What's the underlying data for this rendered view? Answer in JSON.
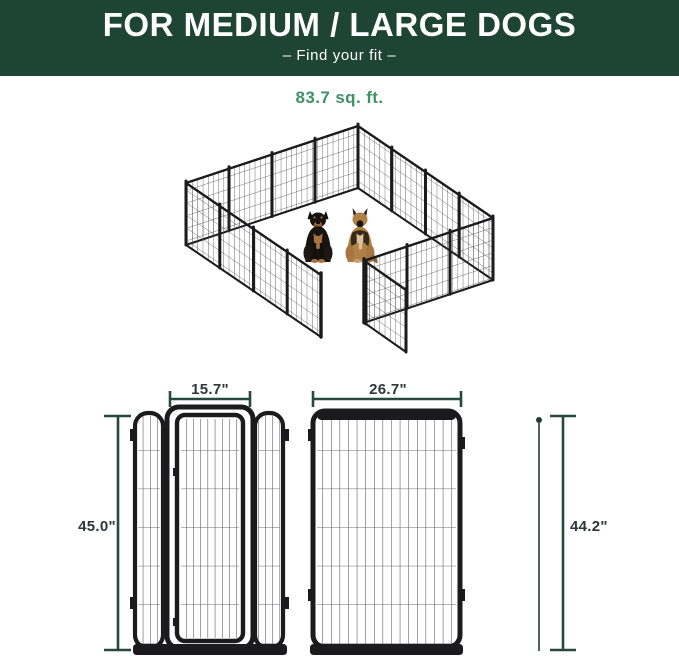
{
  "header": {
    "title": "FOR MEDIUM / LARGE DOGS",
    "subtitle": "–  Find your fit  –"
  },
  "area": {
    "value": "83.7 sq. ft."
  },
  "diagrams": {
    "gate_panel": {
      "width_label": "15.7\"",
      "height_label": "45.0\""
    },
    "regular_panel": {
      "width_label": "26.7\"",
      "height_label": "44.2\""
    }
  },
  "illustration": {
    "scene": "isometric dog playpen with open gate",
    "dogs": [
      "rottweiler",
      "german-shepherd"
    ]
  },
  "colors": {
    "banner_green": "#1d4434",
    "accent_green": "#3f916a",
    "dimension_line_green": "#25493a",
    "label_dark": "#2f3539",
    "fence_black": "#1b1b1d"
  }
}
